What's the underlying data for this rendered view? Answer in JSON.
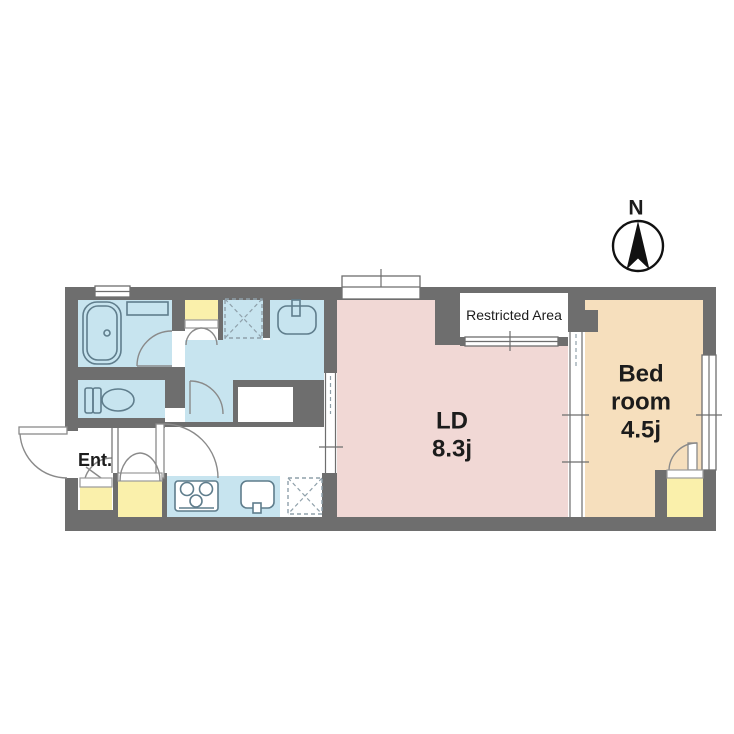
{
  "compass": {
    "label": "N"
  },
  "labels": {
    "entrance": "Ent.",
    "restricted_area": "Restricted Area",
    "ld_name": "LD",
    "ld_size": "8.3j",
    "bedroom_line1": "Bed",
    "bedroom_line2": "room",
    "bedroom_size": "4.5j"
  },
  "colors": {
    "wall": "#6e6e6e",
    "wet_rooms": "#c7e4ef",
    "living_dining": "#f1d8d5",
    "bedroom": "#f6dfbd",
    "closet": "#faf0ab",
    "fixture_line": "#5f7d8c",
    "text": "#1c1c1c",
    "background": "#ffffff"
  }
}
